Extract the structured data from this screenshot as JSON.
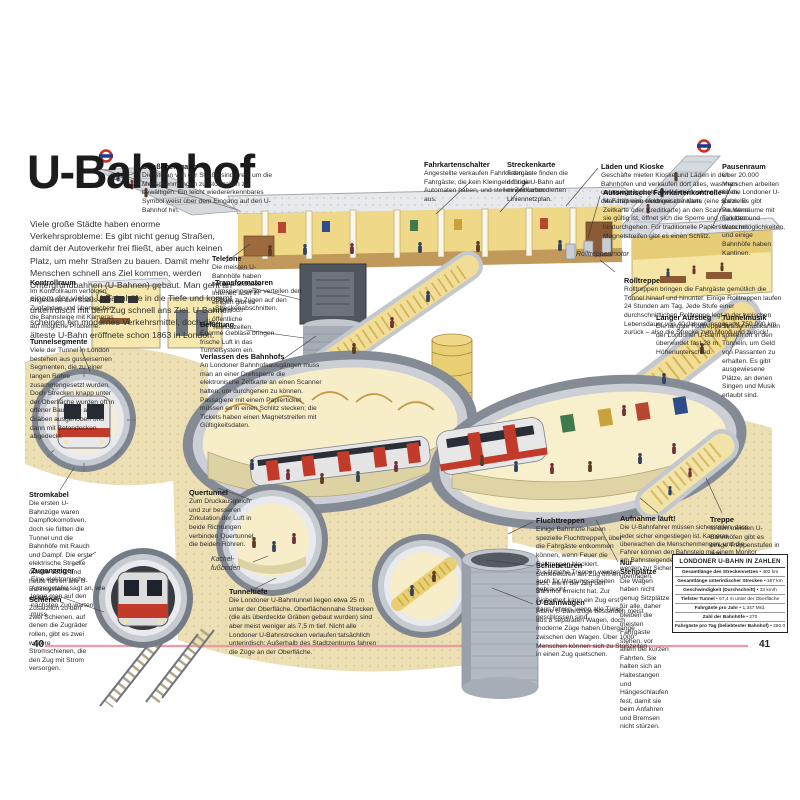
{
  "page": {
    "title": "U-Bahnhof",
    "intro": "Viele große Städte haben enorme Verkehrsprobleme: Es gibt nicht genug Straßen, damit der Autoverkehr frei fließt, aber auch keinen Platz, um mehr Straßen zu bauen. Damit mehr Menschen schnell ans Ziel kommen, werden Untergrundbahnen (U-Bahnen) gebaut. Man geht an einem der vielen U-Bahnhöfe in die Tiefe und kommt unterirdisch mit dem Zug schnell ans Ziel. U-Bahnen scheinen ein modernes Verkehrsmittel, doch die älteste U-Bahn eröffnete schon 1863 in London.",
    "left_page_number": "40",
    "right_page_number": "41"
  },
  "labels": [
    {
      "id": "strasseneingang",
      "title": "Straßeneingang",
      "text": "Die Stufen von der Straße sind breit, um die Menschenmengen zu Stoßzeiten zu bewältigen. Ein leicht wiedererkennbares Symbol weist über dem Eingang auf den U-Bahnhof hin."
    },
    {
      "id": "fahrkartenschalter",
      "title": "Fahrkartenschalter",
      "text": "Angestellte verkaufen Fahrkarten an Fahrgäste, die kein Kleingeld für die Automaten haben, und stellen Zeitkarten aus."
    },
    {
      "id": "streckenkarte",
      "title": "Streckenkarte",
      "text": "Fahrgäste finden die richtige U-Bahn auf einem farbcodierten Liniennetzplan."
    },
    {
      "id": "laeden-und-kioske",
      "title": "Läden und Kioske",
      "text": "Geschäfte mieten Kioske und Läden in den Bahnhöfen und verkaufen dort alles, was man unterwegs braucht. Die Mieteinnahmen helfen, die Fahrpreise niedriger zu halten."
    },
    {
      "id": "fahrkartenkontrolle",
      "title": "Automatische Fahrkartenkontrolle",
      "text": "Man hält eine elektronische Karte (eine spezielle Zeitkarte oder Kreditkarte) an den Scanner. Wenn sie gültig ist, öffnet sich die Sperre und man kann hindurchgehen. Für traditionelle Papiertickets mit Magnetstreifen gibt es einen Schlitz."
    },
    {
      "id": "pausenraum",
      "title": "Pausenraum",
      "text": "Über 20.000 Menschen arbeiten für die Londoner U-Bahn. Es gibt Pausenräume mit Toiletten und Waschmöglichkeiten, und einige Bahnhöfe haben Kantinen."
    },
    {
      "id": "telefone",
      "title": "Telefone",
      "text": "Die meisten U-Bahnhöfe haben heute drahtloses Internet, aber in einigen gibt es auch noch öffentliche Telefonzellen."
    },
    {
      "id": "kontrollraum",
      "title": "Kontrollraum",
      "text": "Im Kontrollraum verfolgen Angestellte den Status aller Zugfahrten und überwachen die Bahnsteige mit Kameras auf mögliche Probleme."
    },
    {
      "id": "transformatoren",
      "title": "Transformatoren",
      "text": "Umspannwerke verteilen den Strom zu Zügen auf den Streckenabschnitten."
    },
    {
      "id": "belueftung",
      "title": "Belüftung",
      "text": "Enorme Gebläse bringen frische Luft in das Tunnelsystem ein."
    },
    {
      "id": "tunnelsegmente",
      "title": "Tunnelsegmente",
      "text": "Viele der Tunnel in London bestehen aus gusseisernen Segmenten, die zu einer langen Röhre zusammengesetzt wurden. Doch Strecken knapp unter der Oberfläche wurden oft in offener Bauweise als Gräben ausgehoben und dann mit Betondecken abgedeckt."
    },
    {
      "id": "verlassen-des-bahnhofs",
      "title": "Verlassen des Bahnhofs",
      "text": "An Londoner Bahnhofsausgängen muss man an einer Drehsperre die elektronische Zeitkarte an einen Scanner halten, um durchgehen zu können. Passagiere mit einem Papierticket müssen es in einen Schlitz stecken; die Tickets haben einen Magnetstreifen mit Gültigkeitsdaten."
    },
    {
      "id": "rolltreppenmotor",
      "title": "Rolltreppenmotor",
      "text": ""
    },
    {
      "id": "rolltreppe",
      "title": "Rolltreppe",
      "text": "Rolltreppen bringen die Fahrgäste gemütlich die Tunnel hinauf und hinunter. Einige Rolltreppen laufen 24 Stunden am Tag. Jede Stufe einer durchschnittlichen Rolltreppe legt in der typischen Lebensdauer von 40 Jahren insgesamt 750.000 km zurück – also die Strecke zum Mond und zurück!"
    },
    {
      "id": "langer-aufstieg",
      "title": "Langer Aufstieg",
      "text": "Die längste Rolltreppe in der Londoner U-Bahn überwindet fast 28 m Höhenunterschied."
    },
    {
      "id": "tunnelmusik",
      "title": "Tunnelmusik",
      "text": "Straßenmusikanten spielen oft in den Tunneln, um Geld von Passanten zu erhalten. Es gibt ausgewiesene Plätze, an denen Singen und Musik erlaubt sind."
    },
    {
      "id": "stromkabel",
      "title": "Stromkabel",
      "text": "Die ersten U-Bahnzüge waren Dampflokomotiven, doch sie füllten die Tunnel und die Bahnhöfe mit Rauch und Dampf. Die erste elektrische Strecke öffnete 1890, und heute fahren alle U-Bahnsysteme elektrisch."
    },
    {
      "id": "quertunnel",
      "title": "Quertunnel",
      "text": "Zum Druckausgleich und zur besseren Zirkulation der Luft in beide Richtungen verbinden Quertunnel die beiden Röhren."
    },
    {
      "id": "zuganzeiger",
      "title": "Zuganzeiger",
      "text": "Eine elektronische Anzeigetafel sagt an, wie lange man auf den nächsten Zug warten muss."
    },
    {
      "id": "schienen",
      "title": "Schienen",
      "text": "Zusätzlich zu den zwei Schienen, auf denen die Zugräder rollen, gibt es zwei weitere Stromschienen, die den Zug mit Strom versorgen."
    },
    {
      "id": "kachelfussboden",
      "title": "Kachel­fußboden",
      "text": ""
    },
    {
      "id": "tunneltiefe",
      "title": "Tunneltiefe",
      "text": "Die Londoner U-Bahntunnel liegen etwa 25 m unter der Oberfläche. Oberflächennahe Strecken (die als überdeckte Gräben gebaut wurden) sind aber meist weniger als 7,5 m tief. Nicht alle Londoner U-Bahnstrecken verlaufen tatsächlich unterirdisch: Außerhalb des Stadtzentrums fahren die Züge an der Oberfläche."
    },
    {
      "id": "fluchttreppen",
      "title": "Fluchttreppen",
      "text": "Einige Bahnhöfe haben spezielle Fluchttreppen, über die Fahrgäste entkommen können, wenn Feuer die Rolltreppen blockiert. Zusätzliche Treppen werden auch für Wartungsarbeiten gebraucht."
    },
    {
      "id": "schiebetueren",
      "title": "Schiebetüren",
      "text": "Schiebetüren am Zug öffnen sich, wenn der Zug den Bahnhof erreicht hat. Zur Sicherheit kann ein Zug erst dann fahren, wenn alle Türen geschlossen sind."
    },
    {
      "id": "u-bahnwagen",
      "title": "U-Bahnwagen",
      "text": "Ältere U-Bahnzüge bestanden meist aus 8 separaten Wagen, doch moderne Züge haben Übergänge zwischen den Wagen. Über 1000 Menschen können sich zu Stoßzeiten in einen Zug quetschen."
    },
    {
      "id": "aufnahme-laeuft",
      "title": "Aufnahme läuft!",
      "text": "Die U-Bahnfahrer müssen sicherstellen, dass jeder sicher eingestiegen ist. Kameras überwachen die Menschenmengen, und die Fahrer können den Bahnsteig mit einem Monitor am Bahnsteigende kontrollieren. Die Bilder werden zur Sicherheit auch in den Kontrollraum übertragen."
    },
    {
      "id": "nur-stehplaetze",
      "title": "Nur Stehplätze",
      "text": "Die Wagen haben nicht genug Sitzplätze für alle, daher bleiben die meisten Fahrgäste stehen, vor allem bei kurzen Fahrten. Sie halten sich an Haltestangen und Hängeschlaufen fest, damit sie beim Anfahren und Bremsen nicht stürzen."
    },
    {
      "id": "treppe",
      "title": "Treppe",
      "text": "In den meisten U-Bahnhöfen gibt es einige Treppenstufen in den Verbindungstunneln zu den Bahnsteigen."
    }
  ],
  "stats_box": {
    "title": "LONDONER U-BAHN IN ZAHLEN",
    "bullet": "•",
    "rows": [
      {
        "label": "Gesamtlänge des Streckennetzes",
        "value": "402 km"
      },
      {
        "label": "Gesamtlänge unterirdischer Strecken",
        "value": "167 km"
      },
      {
        "label": "Geschwindigkeit (Durchschnitt)",
        "value": "33 km/h"
      },
      {
        "label": "Tiefster Tunnel",
        "value": "67,4 m unter der Oberfläche"
      },
      {
        "label": "Fahrgäste pro Jahr",
        "value": "1,347 Mrd."
      },
      {
        "label": "Zahl der Bahnhöfe",
        "value": "270"
      },
      {
        "label": "Fahrgäste pro Tag (beliebtester Bahnhof)",
        "value": "260.000"
      }
    ]
  },
  "colors": {
    "accent_red": "#c23b2a",
    "tunnel_yellow": "#f3e09c",
    "tunnel_gray": "#c6cad1",
    "soil_beige": "#ecdfb4",
    "page_rule_pink": "#ef9aa0",
    "roundel_red": "#cf2b25",
    "roundel_blue": "#1d3d8f"
  }
}
